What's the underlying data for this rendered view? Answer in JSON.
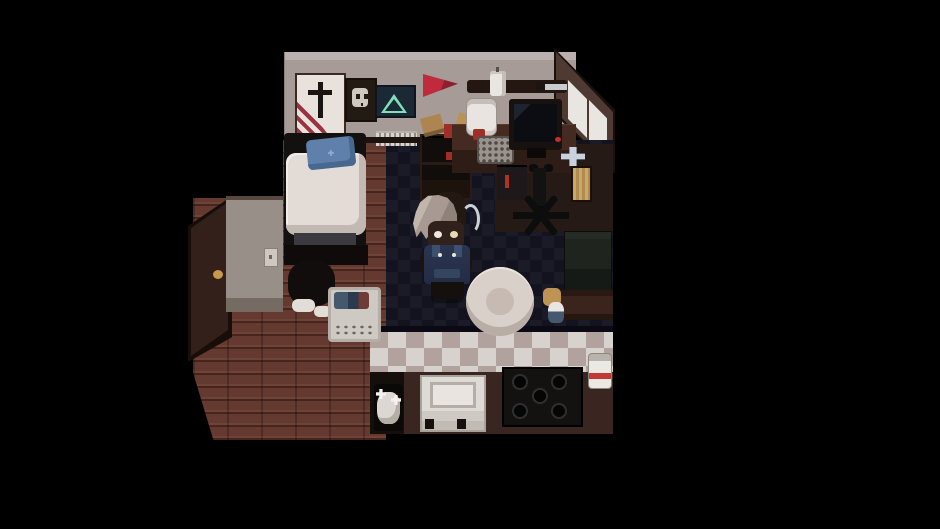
{
  "meta": {
    "description": "Pixel-art RPG interior: dark bedroom-kitchen room with gray-haired character, viewed top-down on black letterboxed background",
    "viewport": {
      "width": 940,
      "height": 529,
      "background": "#000000"
    }
  },
  "palette": {
    "background": "#000000",
    "wall": "#a69b96",
    "window_wall": "#4e3a32",
    "wood_floor": "#64392f",
    "carpet_dark": "#131320",
    "carpet_light": "#1b1b27",
    "tile_light": "#d8d2ce",
    "tile_dark": "#b1a29e",
    "kitchen_brown": "#3a2620",
    "accent_red": "#9e2f28",
    "pennant_red": "#bf2b3c",
    "pillow_blue": "#5f80ab",
    "overalls_blue": "#2a3550",
    "hair_gray": "#a89a92",
    "poster_green": "#7fe0b8"
  },
  "scene": {
    "objects": [
      {
        "name": "top-wall",
        "x": 284,
        "y": 52,
        "w": 292,
        "h": 88,
        "cls": "wall-top"
      },
      {
        "name": "window-wall-frame",
        "x": 554,
        "y": 48,
        "w": 61,
        "h": 126,
        "color": "#1a100c",
        "clip": "polygon(0 0,100% 49%,100% 100%,0 52%)"
      },
      {
        "name": "window-wall",
        "x": 556,
        "y": 52,
        "w": 57,
        "h": 118,
        "color": "#4e3a32",
        "clip": "polygon(0 0,100% 51%,100% 100%,0 51%)"
      },
      {
        "name": "window-left",
        "x": 568,
        "y": 80,
        "w": 19,
        "h": 58,
        "color": "#e9e5e1",
        "clip": "polygon(0 0,100% 33%,100% 100%,0 67%)"
      },
      {
        "name": "window-right",
        "x": 589,
        "y": 100,
        "w": 18,
        "h": 59,
        "color": "#e9e5e1",
        "clip": "polygon(0 0,100% 31%,100% 100%,0 69%)"
      },
      {
        "name": "hallway-wood-floor",
        "x": 193,
        "y": 140,
        "w": 193,
        "h": 300,
        "cls": "floor-wood"
      },
      {
        "name": "carpet",
        "x": 386,
        "y": 140,
        "w": 227,
        "h": 192,
        "cls": "carpet-checker"
      },
      {
        "name": "floor-under-desk",
        "x": 495,
        "y": 144,
        "w": 118,
        "h": 88,
        "color": "#251a16"
      },
      {
        "name": "kitchen-tile-floor",
        "x": 370,
        "y": 330,
        "w": 243,
        "h": 44,
        "cls": "tile-checker"
      },
      {
        "name": "kitchen-floor-dark",
        "x": 370,
        "y": 372,
        "w": 34,
        "h": 62,
        "color": "#150f0c"
      },
      {
        "name": "kitchen-floor",
        "x": 404,
        "y": 372,
        "w": 209,
        "h": 62,
        "color": "#3a2620"
      },
      {
        "name": "kitchen-edge-shadow",
        "x": 370,
        "y": 326,
        "w": 243,
        "h": 6,
        "color": "#0b0913"
      },
      {
        "name": "mask-above-door",
        "x": 186,
        "y": 40,
        "w": 97,
        "h": 158,
        "color": "#000000"
      },
      {
        "name": "mask-door-corner",
        "x": 188,
        "y": 356,
        "w": 26,
        "h": 86,
        "color": "#000000",
        "clip": "polygon(0 0,100% 100%,0 100%)"
      },
      {
        "name": "poster-sword",
        "x": 295,
        "y": 73,
        "w": 47,
        "h": 62,
        "color": "#e9e2dc",
        "cls": "poster-sword"
      },
      {
        "name": "poster-sword-stripes",
        "x": 297,
        "y": 95,
        "w": 30,
        "h": 38,
        "cls": "sword-stripes"
      },
      {
        "name": "poster-skull",
        "x": 345,
        "y": 78,
        "w": 28,
        "h": 40,
        "color": "#241a14",
        "cls": "poster-skull"
      },
      {
        "name": "poster-triangle",
        "x": 375,
        "y": 85,
        "w": 37,
        "h": 29,
        "color": "#1b2836",
        "cls": "poster-tri"
      },
      {
        "name": "pennant-flag",
        "x": 423,
        "y": 73,
        "w": 35,
        "h": 24,
        "cls": "pennant",
        "clip": "polygon(0 4%,100% 45%,0 100%)"
      },
      {
        "name": "wall-shelf",
        "x": 467,
        "y": 80,
        "w": 100,
        "h": 13,
        "color": "#241711",
        "radius": "3px"
      },
      {
        "name": "hanging-mug",
        "x": 490,
        "y": 71,
        "w": 16,
        "h": 25,
        "color": "#e9e5e1",
        "cls": "mug"
      },
      {
        "name": "knife-handle",
        "x": 536,
        "y": 82,
        "w": 10,
        "h": 9,
        "color": "#1d1512"
      },
      {
        "name": "knife-blade",
        "x": 545,
        "y": 84,
        "w": 22,
        "h": 6,
        "color": "#c9cdd0"
      },
      {
        "name": "radiator",
        "x": 376,
        "y": 131,
        "w": 41,
        "h": 13,
        "cls": "radiator"
      },
      {
        "name": "wall-base-shadow",
        "x": 284,
        "y": 137,
        "w": 292,
        "h": 6,
        "color": "#1c130f"
      },
      {
        "name": "door-frame",
        "x": 188,
        "y": 196,
        "w": 44,
        "h": 166,
        "color": "#170e0a",
        "clip": "polygon(0 18%,100% 0,100% 85%,0 100%)"
      },
      {
        "name": "door",
        "x": 191,
        "y": 202,
        "w": 37,
        "h": 154,
        "color": "#33201a",
        "cls": "door-grain",
        "clip": "polygon(0 17%,100% 0,100% 83%,0 100%)"
      },
      {
        "name": "door-handle",
        "x": 213,
        "y": 270,
        "w": 10,
        "h": 9,
        "color": "#c79a4b",
        "radius": "50%"
      },
      {
        "name": "entry-wall",
        "x": 226,
        "y": 196,
        "w": 57,
        "h": 116,
        "cls": "wall-side"
      },
      {
        "name": "light-switch",
        "x": 264,
        "y": 248,
        "w": 12,
        "h": 17,
        "color": "#cfc8c0",
        "cls": "switch"
      },
      {
        "name": "bed-frame",
        "x": 284,
        "y": 133,
        "w": 82,
        "h": 132,
        "color": "#131010",
        "radius": "4px"
      },
      {
        "name": "bed-mattress",
        "x": 286,
        "y": 153,
        "w": 80,
        "h": 82,
        "color": "#e3dcd6",
        "radius": "10px",
        "cls": "mattress"
      },
      {
        "name": "bed-pillow",
        "x": 307,
        "y": 138,
        "w": 48,
        "h": 30,
        "color": "#5f80ab",
        "cls": "pillow",
        "rotate": -6
      },
      {
        "name": "bed-blanket-fold",
        "x": 294,
        "y": 233,
        "w": 62,
        "h": 15,
        "color": "#3b3a40"
      },
      {
        "name": "bed-footboard",
        "x": 284,
        "y": 245,
        "w": 84,
        "h": 20,
        "color": "#0f0b0a"
      },
      {
        "name": "clothes-pile",
        "x": 288,
        "y": 261,
        "w": 47,
        "h": 45,
        "color": "#110d0c",
        "radius": "40%"
      },
      {
        "name": "sock-left",
        "x": 292,
        "y": 299,
        "w": 23,
        "h": 13,
        "color": "#e3ddd7",
        "radius": "6px"
      },
      {
        "name": "sock-right",
        "x": 314,
        "y": 306,
        "w": 17,
        "h": 11,
        "color": "#e3ddd7",
        "radius": "5px"
      },
      {
        "name": "laundry-basket",
        "x": 328,
        "y": 287,
        "w": 47,
        "h": 49,
        "cls": "basket"
      },
      {
        "name": "laundry-clothes",
        "x": 334,
        "y": 292,
        "w": 35,
        "h": 17,
        "cls": "basket-clothes"
      },
      {
        "name": "bookcase",
        "x": 420,
        "y": 134,
        "w": 48,
        "h": 62,
        "color": "#110d0b",
        "cls": "bookcase"
      },
      {
        "name": "bookcase-red-item",
        "x": 446,
        "y": 152,
        "w": 10,
        "h": 8,
        "color": "#a22c28"
      },
      {
        "name": "parcel",
        "x": 422,
        "y": 116,
        "w": 21,
        "h": 19,
        "color": "#ac8550",
        "cls": "parcel",
        "rotate": -15
      },
      {
        "name": "red-box",
        "x": 444,
        "y": 124,
        "w": 17,
        "h": 14,
        "color": "#9e2f28"
      },
      {
        "name": "blue-case",
        "x": 455,
        "y": 132,
        "w": 13,
        "h": 9,
        "color": "#2e3d58"
      },
      {
        "name": "envelope",
        "x": 457,
        "y": 115,
        "w": 21,
        "h": 13,
        "color": "#b99258",
        "rotate": 18
      },
      {
        "name": "desk",
        "x": 452,
        "y": 124,
        "w": 124,
        "h": 49,
        "cls": "desk"
      },
      {
        "name": "rice-cooker",
        "x": 466,
        "y": 98,
        "w": 29,
        "h": 36,
        "color": "#e9e4df",
        "cls": "cooker"
      },
      {
        "name": "red-cup",
        "x": 473,
        "y": 129,
        "w": 12,
        "h": 11,
        "color": "#9e2f28",
        "radius": "2px"
      },
      {
        "name": "speaker-grille",
        "x": 477,
        "y": 136,
        "w": 33,
        "h": 24,
        "cls": "speaker",
        "radius": "4px"
      },
      {
        "name": "monitor",
        "x": 509,
        "y": 99,
        "w": 53,
        "h": 51,
        "color": "#17120f",
        "cls": "monitor"
      },
      {
        "name": "monitor-stand",
        "x": 527,
        "y": 148,
        "w": 19,
        "h": 10,
        "color": "#0c0908"
      },
      {
        "name": "desk-led",
        "x": 555,
        "y": 137,
        "w": 6,
        "h": 5,
        "color": "#c03226",
        "radius": "50%"
      },
      {
        "name": "under-desk-unit",
        "x": 497,
        "y": 165,
        "w": 30,
        "h": 35,
        "color": "#1e181a",
        "cls": "unit"
      },
      {
        "name": "chair-armrest-left",
        "x": 529,
        "y": 164,
        "w": 9,
        "h": 8,
        "color": "#0c0c0c",
        "radius": "40%"
      },
      {
        "name": "chair-armrest-right",
        "x": 544,
        "y": 164,
        "w": 9,
        "h": 8,
        "color": "#0c0c0c",
        "radius": "40%"
      },
      {
        "name": "office-chair-pole",
        "x": 533,
        "y": 168,
        "w": 13,
        "h": 38,
        "color": "#121212",
        "cls": "pole"
      },
      {
        "name": "office-chair-base",
        "x": 513,
        "y": 200,
        "w": 56,
        "h": 30,
        "cls": "chair-star"
      },
      {
        "name": "gamepad-dpad",
        "x": 561,
        "y": 147,
        "w": 24,
        "h": 19,
        "color": "#c8d2de",
        "clip": "polygon(35% 0,65% 0,65% 35%,100% 35%,100% 65%,65% 65%,65% 100%,35% 100%,35% 65%,0 65%,0 35%,35% 35%)"
      },
      {
        "name": "leaning-board",
        "x": 571,
        "y": 166,
        "w": 17,
        "h": 32,
        "cls": "board"
      },
      {
        "name": "couch",
        "x": 564,
        "y": 231,
        "w": 48,
        "h": 60,
        "cls": "couch"
      },
      {
        "name": "cabinet",
        "x": 561,
        "y": 290,
        "w": 52,
        "h": 30,
        "cls": "cabinet"
      },
      {
        "name": "toy-cookie",
        "x": 543,
        "y": 288,
        "w": 18,
        "h": 18,
        "color": "#bd9455",
        "cls": "toy",
        "radius": "30%"
      },
      {
        "name": "toy-doll",
        "x": 548,
        "y": 302,
        "w": 16,
        "h": 21,
        "cls": "doll"
      },
      {
        "name": "player-head-back",
        "x": 432,
        "y": 192,
        "w": 34,
        "h": 42,
        "color": "#241812",
        "radius": "35%"
      },
      {
        "name": "player-hair",
        "x": 413,
        "y": 195,
        "w": 44,
        "h": 46,
        "cls": "hair"
      },
      {
        "name": "player-hair-curl",
        "x": 461,
        "y": 204,
        "w": 13,
        "h": 24,
        "cls": "curl"
      },
      {
        "name": "player-face",
        "x": 428,
        "y": 221,
        "w": 36,
        "h": 29,
        "color": "#30211c",
        "radius": "25%"
      },
      {
        "name": "player-eye-left",
        "x": 434,
        "y": 231,
        "w": 8,
        "h": 7,
        "color": "#ece8da",
        "radius": "50%"
      },
      {
        "name": "player-eye-right",
        "x": 450,
        "y": 231,
        "w": 8,
        "h": 7,
        "color": "#e8d9b8",
        "radius": "50%"
      },
      {
        "name": "player-arm-left",
        "x": 420,
        "y": 252,
        "w": 8,
        "h": 22,
        "color": "#1c1210",
        "radius": "40%"
      },
      {
        "name": "player-arm-right",
        "x": 464,
        "y": 252,
        "w": 8,
        "h": 22,
        "color": "#1c1210",
        "radius": "40%"
      },
      {
        "name": "player-overalls",
        "x": 424,
        "y": 245,
        "w": 46,
        "h": 39,
        "cls": "overalls"
      },
      {
        "name": "player-button-left",
        "x": 438,
        "y": 253,
        "w": 4,
        "h": 4,
        "color": "#e8e4dc",
        "radius": "50%"
      },
      {
        "name": "player-button-right",
        "x": 452,
        "y": 253,
        "w": 4,
        "h": 4,
        "color": "#e8e4dc",
        "radius": "50%"
      },
      {
        "name": "player-legs",
        "x": 431,
        "y": 282,
        "w": 33,
        "h": 17,
        "color": "#15100d",
        "cls": "legs"
      },
      {
        "name": "floor-pouf",
        "x": 466,
        "y": 267,
        "w": 68,
        "h": 69,
        "color": "#d9d0c9",
        "radius": "50%",
        "cls": "pouf"
      },
      {
        "name": "cat-mat",
        "x": 374,
        "y": 384,
        "w": 29,
        "h": 47,
        "color": "#0b0908",
        "radius": "3px"
      },
      {
        "name": "cat",
        "x": 377,
        "y": 392,
        "w": 23,
        "h": 32,
        "color": "#dcd7d2",
        "radius": "40%",
        "cls": "cat"
      },
      {
        "name": "kitchen-table",
        "x": 420,
        "y": 375,
        "w": 62,
        "h": 53,
        "cls": "table"
      },
      {
        "name": "table-leg-left",
        "x": 425,
        "y": 419,
        "w": 9,
        "h": 10,
        "color": "#17100c"
      },
      {
        "name": "table-leg-right",
        "x": 457,
        "y": 419,
        "w": 9,
        "h": 10,
        "color": "#17100c"
      },
      {
        "name": "stove",
        "x": 502,
        "y": 367,
        "w": 77,
        "h": 56,
        "cls": "stove"
      },
      {
        "name": "pet-bowl",
        "x": 588,
        "y": 353,
        "w": 22,
        "h": 34,
        "cls": "bowl"
      }
    ]
  }
}
